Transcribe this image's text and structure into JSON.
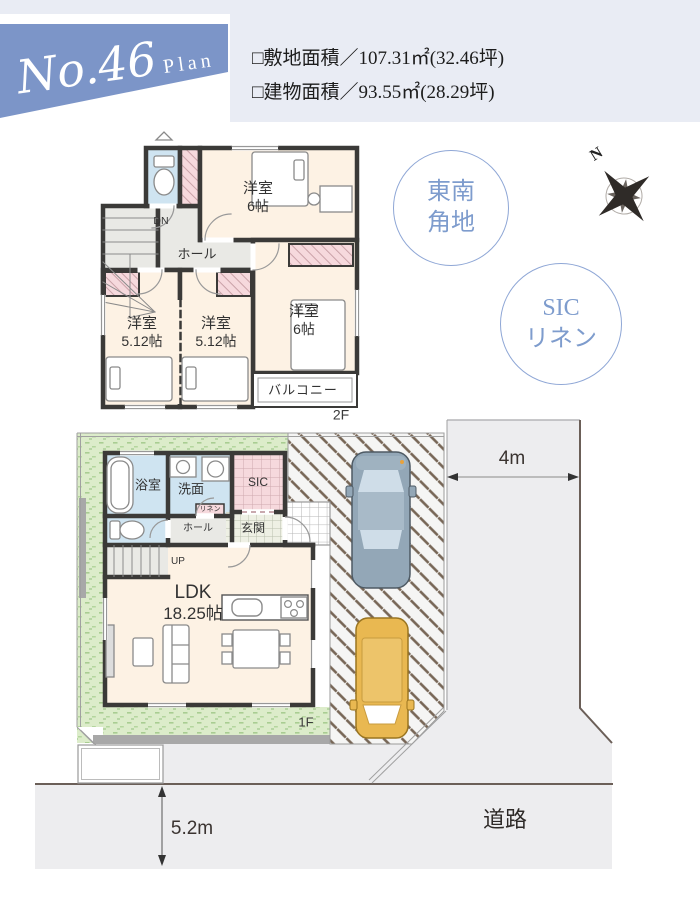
{
  "header": {
    "plan_no": "No.46",
    "plan_word": "Plan",
    "site_area": "□敷地面積／107.31㎡(32.46坪)",
    "building_area": "□建物面積／93.55㎡(28.29坪)"
  },
  "badges": {
    "corner_lot": {
      "line1": "東南",
      "line2": "角地"
    },
    "storage": {
      "line1": "SIC",
      "line2": "リネン"
    }
  },
  "compass": {
    "north": "N"
  },
  "floor2": {
    "floor_label": "2F",
    "bedroom_top": {
      "name": "洋室",
      "size": "6帖"
    },
    "bedroom_right": {
      "name": "洋室",
      "size": "6帖"
    },
    "bedroom_left": {
      "name": "洋室",
      "size": "5.12帖"
    },
    "bedroom_mid": {
      "name": "洋室",
      "size": "5.12帖"
    },
    "hall": "ホール",
    "stairs_dn": "DN",
    "balcony": "バルコニー"
  },
  "floor1": {
    "floor_label": "1F",
    "bath": "浴室",
    "washroom": "洗面",
    "shoe_closet": "SIC",
    "linen": "リネン",
    "entrance": "玄関",
    "hall": "ホール",
    "stairs_up": "UP",
    "ldk": {
      "name": "LDK",
      "size": "18.25帖"
    }
  },
  "site": {
    "road_width": "4m",
    "frontage": "5.2m",
    "road": "道路"
  },
  "colors": {
    "banner_blue": "#7c95c8",
    "header_bg": "#e9ecf4",
    "accent_blue": "#8fa7d6",
    "room_cream": "#fdf2e4",
    "water_blue": "#cfe4f1",
    "closet_pink": "#f6d9dd",
    "garden_green": "#dcecca",
    "road_gray": "#ededef",
    "wall_dark": "#3b3a38",
    "car_gray": "#93a7b7",
    "car_yellow": "#e9b851"
  }
}
